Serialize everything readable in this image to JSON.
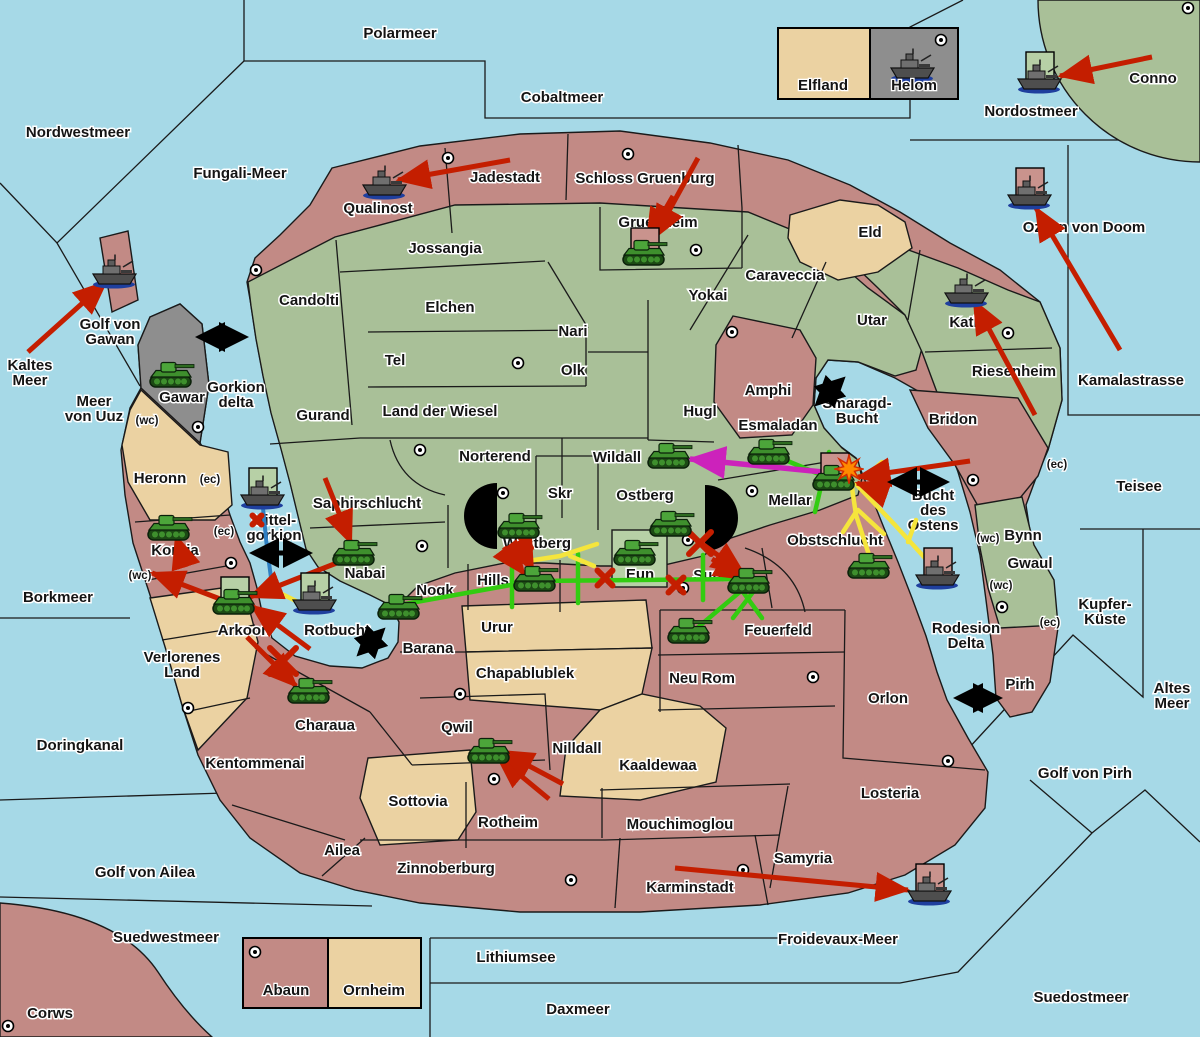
{
  "colors": {
    "sea": "#A6D9E7",
    "land_green": "#A9C098",
    "land_pink": "#C28A85",
    "land_tan": "#EBD2A2",
    "land_gray": "#8E8E8E",
    "box_green": "#B7D0A6",
    "box_pink": "#C9938D",
    "arrow_red": "#C41E00",
    "line_green": "#33CC11",
    "line_yellow": "#F5E53C",
    "line_magenta": "#CC22BB",
    "line_blue": "#2E7FC2",
    "strait_black": "#000000",
    "explosion_orange": "#FF8A00"
  },
  "sea_labels": [
    {
      "text": "Polarmeer",
      "x": 400,
      "y": 38
    },
    {
      "text": "Cobaltmeer",
      "x": 562,
      "y": 102
    },
    {
      "text": "Nordwestmeer",
      "x": 78,
      "y": 137
    },
    {
      "text": "Fungali-Meer",
      "x": 240,
      "y": 178
    },
    {
      "text": "Nordostmeer",
      "x": 1031,
      "y": 116
    },
    {
      "text": "Ozean von Doom",
      "x": 1084,
      "y": 232
    },
    {
      "text": "Kamalastrasse",
      "x": 1131,
      "y": 385
    },
    {
      "text": "Teisee",
      "x": 1139,
      "y": 491
    },
    {
      "text": "Kaltes\nMeer",
      "x": 30,
      "y": 370
    },
    {
      "text": "Meer\nvon Uuz",
      "x": 94,
      "y": 406
    },
    {
      "text": "Golf von\nGawan",
      "x": 110,
      "y": 329
    },
    {
      "text": "Gorkion\ndelta",
      "x": 236,
      "y": 392
    },
    {
      "text": "Mittel-\ngorkion",
      "x": 274,
      "y": 525
    },
    {
      "text": "Borkmeer",
      "x": 58,
      "y": 602
    },
    {
      "text": "Rotbucht",
      "x": 337,
      "y": 635
    },
    {
      "text": "Doringkanal",
      "x": 80,
      "y": 750
    },
    {
      "text": "Golf von Ailea",
      "x": 145,
      "y": 877
    },
    {
      "text": "Suedwestmeer",
      "x": 166,
      "y": 942
    },
    {
      "text": "Lithiumsee",
      "x": 516,
      "y": 962
    },
    {
      "text": "Daxmeer",
      "x": 578,
      "y": 1014
    },
    {
      "text": "Froidevaux-Meer",
      "x": 838,
      "y": 944
    },
    {
      "text": "Suedostmeer",
      "x": 1081,
      "y": 1002
    },
    {
      "text": "Golf von Pirh",
      "x": 1085,
      "y": 778
    },
    {
      "text": "Altes\nMeer",
      "x": 1172,
      "y": 693
    },
    {
      "text": "Kupfer-\nKüste",
      "x": 1105,
      "y": 609
    },
    {
      "text": "Smaragd-\nBucht",
      "x": 857,
      "y": 408
    },
    {
      "text": "Bucht\ndes\nOstens",
      "x": 933,
      "y": 500
    },
    {
      "text": "Rodesion\nDelta",
      "x": 966,
      "y": 633
    }
  ],
  "territory_labels": [
    {
      "text": "Qualinost",
      "x": 378,
      "y": 213
    },
    {
      "text": "Jadestadt",
      "x": 505,
      "y": 182
    },
    {
      "text": "Schloss Gruenburg",
      "x": 645,
      "y": 183
    },
    {
      "text": "Gruenheim",
      "x": 658,
      "y": 227
    },
    {
      "text": "Eld",
      "x": 870,
      "y": 237
    },
    {
      "text": "Conno",
      "x": 1153,
      "y": 83
    },
    {
      "text": "Jossangia",
      "x": 445,
      "y": 253
    },
    {
      "text": "Candolti",
      "x": 309,
      "y": 305
    },
    {
      "text": "Elchen",
      "x": 450,
      "y": 312
    },
    {
      "text": "Tel",
      "x": 395,
      "y": 365
    },
    {
      "text": "Nari",
      "x": 573,
      "y": 336
    },
    {
      "text": "Olk",
      "x": 573,
      "y": 375
    },
    {
      "text": "Yokai",
      "x": 708,
      "y": 300
    },
    {
      "text": "Caraveccia",
      "x": 785,
      "y": 280
    },
    {
      "text": "Utar",
      "x": 872,
      "y": 325
    },
    {
      "text": "Kath",
      "x": 966,
      "y": 327
    },
    {
      "text": "Riesenheim",
      "x": 1014,
      "y": 376
    },
    {
      "text": "Bridon",
      "x": 953,
      "y": 424
    },
    {
      "text": "Gurand",
      "x": 323,
      "y": 420
    },
    {
      "text": "Land der Wiesel",
      "x": 440,
      "y": 416
    },
    {
      "text": "Hugl",
      "x": 700,
      "y": 416
    },
    {
      "text": "Amphi",
      "x": 768,
      "y": 395
    },
    {
      "text": "Esmaladan",
      "x": 778,
      "y": 430
    },
    {
      "text": "Norterend",
      "x": 495,
      "y": 461
    },
    {
      "text": "Wildall",
      "x": 617,
      "y": 462
    },
    {
      "text": "Skr",
      "x": 560,
      "y": 498
    },
    {
      "text": "Ostberg",
      "x": 645,
      "y": 500
    },
    {
      "text": "Mellar",
      "x": 790,
      "y": 505
    },
    {
      "text": "Gawar",
      "x": 182,
      "y": 402
    },
    {
      "text": "Heronn",
      "x": 160,
      "y": 483
    },
    {
      "text": "Saphirschlucht",
      "x": 367,
      "y": 508
    },
    {
      "text": "Korbia",
      "x": 175,
      "y": 555
    },
    {
      "text": "Nabai",
      "x": 365,
      "y": 578
    },
    {
      "text": "Westberg",
      "x": 537,
      "y": 548
    },
    {
      "text": "Hills",
      "x": 493,
      "y": 585
    },
    {
      "text": "Eun",
      "x": 640,
      "y": 579
    },
    {
      "text": "Sund",
      "x": 712,
      "y": 580
    },
    {
      "text": "Obstschlucht",
      "x": 835,
      "y": 545
    },
    {
      "text": "Nogk",
      "x": 435,
      "y": 595
    },
    {
      "text": "Urur",
      "x": 497,
      "y": 632
    },
    {
      "text": "Barana",
      "x": 428,
      "y": 653
    },
    {
      "text": "Feuerfeld",
      "x": 778,
      "y": 635
    },
    {
      "text": "Arkoon",
      "x": 244,
      "y": 635
    },
    {
      "text": "Verlorenes\nLand",
      "x": 182,
      "y": 662
    },
    {
      "text": "Chapablublek",
      "x": 525,
      "y": 678
    },
    {
      "text": "Neu Rom",
      "x": 702,
      "y": 683
    },
    {
      "text": "Orlon",
      "x": 888,
      "y": 703
    },
    {
      "text": "Charaua",
      "x": 325,
      "y": 730
    },
    {
      "text": "Qwil",
      "x": 457,
      "y": 732
    },
    {
      "text": "Nilldall",
      "x": 577,
      "y": 753
    },
    {
      "text": "Kentommenai",
      "x": 255,
      "y": 768
    },
    {
      "text": "Kaaldewaa",
      "x": 658,
      "y": 770
    },
    {
      "text": "Sottovia",
      "x": 418,
      "y": 806
    },
    {
      "text": "Rotheim",
      "x": 508,
      "y": 827
    },
    {
      "text": "Mouchimoglou",
      "x": 680,
      "y": 829
    },
    {
      "text": "Ailea",
      "x": 342,
      "y": 855
    },
    {
      "text": "Zinnoberburg",
      "x": 446,
      "y": 873
    },
    {
      "text": "Samyria",
      "x": 803,
      "y": 863
    },
    {
      "text": "Losteria",
      "x": 890,
      "y": 798
    },
    {
      "text": "Karminstadt",
      "x": 690,
      "y": 892
    },
    {
      "text": "Bynn",
      "x": 1023,
      "y": 540
    },
    {
      "text": "Gwaul",
      "x": 1030,
      "y": 568
    },
    {
      "text": "Pirh",
      "x": 1020,
      "y": 689
    },
    {
      "text": "Corws",
      "x": 50,
      "y": 1018
    }
  ],
  "small_labels": [
    {
      "text": "(wc)",
      "x": 147,
      "y": 424
    },
    {
      "text": "(ec)",
      "x": 210,
      "y": 483
    },
    {
      "text": "(ec)",
      "x": 224,
      "y": 535
    },
    {
      "text": "(wc)",
      "x": 140,
      "y": 579
    },
    {
      "text": "(ec)",
      "x": 1057,
      "y": 468
    },
    {
      "text": "(wc)",
      "x": 988,
      "y": 542
    },
    {
      "text": "(wc)",
      "x": 1001,
      "y": 589
    },
    {
      "text": "(ec)",
      "x": 1050,
      "y": 626
    }
  ],
  "capital_dots": [
    [
      448,
      158
    ],
    [
      628,
      154
    ],
    [
      696,
      250
    ],
    [
      256,
      270
    ],
    [
      518,
      363
    ],
    [
      732,
      332
    ],
    [
      420,
      450
    ],
    [
      503,
      493
    ],
    [
      752,
      491
    ],
    [
      688,
      540
    ],
    [
      683,
      588
    ],
    [
      198,
      427
    ],
    [
      231,
      563
    ],
    [
      422,
      546
    ],
    [
      188,
      708
    ],
    [
      460,
      694
    ],
    [
      494,
      779
    ],
    [
      571,
      880
    ],
    [
      743,
      870
    ],
    [
      813,
      677
    ],
    [
      973,
      480
    ],
    [
      1002,
      607
    ],
    [
      948,
      761
    ],
    [
      1008,
      333
    ],
    [
      1188,
      8
    ],
    [
      941,
      40
    ],
    [
      255,
      952
    ],
    [
      8,
      1026
    ]
  ],
  "tanks": [
    {
      "x": 172,
      "y": 375,
      "box": null,
      "loc": "Gawar"
    },
    {
      "x": 645,
      "y": 253,
      "box": "pink",
      "loc": "Gruenheim"
    },
    {
      "x": 670,
      "y": 456,
      "box": null,
      "loc": "Wildall"
    },
    {
      "x": 770,
      "y": 452,
      "box": null,
      "loc": "Esmaladan"
    },
    {
      "x": 835,
      "y": 478,
      "box": "pink",
      "loc": "Mellar"
    },
    {
      "x": 170,
      "y": 528,
      "box": null,
      "loc": "Korbia"
    },
    {
      "x": 355,
      "y": 553,
      "box": null,
      "loc": "Nabai"
    },
    {
      "x": 235,
      "y": 602,
      "box": "green",
      "loc": "Arkoon"
    },
    {
      "x": 310,
      "y": 691,
      "box": null,
      "loc": "Charaua"
    },
    {
      "x": 400,
      "y": 607,
      "box": null,
      "loc": "Nogk"
    },
    {
      "x": 520,
      "y": 526,
      "box": null,
      "loc": "Westberg"
    },
    {
      "x": 536,
      "y": 579,
      "box": null,
      "loc": "Hills"
    },
    {
      "x": 636,
      "y": 553,
      "box": null,
      "loc": "Eun"
    },
    {
      "x": 672,
      "y": 524,
      "box": null,
      "loc": "Ostberg"
    },
    {
      "x": 750,
      "y": 581,
      "box": null,
      "loc": "Sund"
    },
    {
      "x": 690,
      "y": 631,
      "box": null,
      "loc": "Feuerfeld"
    },
    {
      "x": 870,
      "y": 566,
      "box": null,
      "loc": "Obstschlucht"
    },
    {
      "x": 490,
      "y": 751,
      "box": null,
      "loc": "Rotheim"
    }
  ],
  "ships": [
    {
      "x": 385,
      "y": 183,
      "box": null,
      "loc": "Qualinost"
    },
    {
      "x": 115,
      "y": 272,
      "box": null,
      "loc": "Golf von Gawan"
    },
    {
      "x": 263,
      "y": 493,
      "box": "green",
      "loc": "Mittelgorkion"
    },
    {
      "x": 315,
      "y": 598,
      "box": "green",
      "loc": "Rotbucht"
    },
    {
      "x": 1040,
      "y": 77,
      "box": "green",
      "loc": "Nordostmeer"
    },
    {
      "x": 1030,
      "y": 193,
      "box": "pink",
      "loc": "Ozean von Doom"
    },
    {
      "x": 967,
      "y": 291,
      "box": null,
      "loc": "Kath"
    },
    {
      "x": 938,
      "y": 573,
      "box": "pink",
      "loc": "Bucht des Ostens"
    },
    {
      "x": 930,
      "y": 889,
      "box": "pink",
      "loc": "Froidevaux-Meer"
    }
  ],
  "red_arrows": [
    [
      510,
      160,
      398,
      180
    ],
    [
      28,
      352,
      106,
      282
    ],
    [
      698,
      158,
      654,
      238
    ],
    [
      673,
      196,
      647,
      241
    ],
    [
      1152,
      57,
      1060,
      76
    ],
    [
      1120,
      350,
      1036,
      208
    ],
    [
      1035,
      415,
      974,
      301
    ],
    [
      970,
      461,
      858,
      477
    ],
    [
      880,
      491,
      857,
      483
    ],
    [
      325,
      478,
      351,
      543
    ],
    [
      352,
      557,
      250,
      597
    ],
    [
      310,
      649,
      252,
      606
    ],
    [
      247,
      637,
      296,
      686
    ],
    [
      186,
      567,
      176,
      536
    ],
    [
      228,
      602,
      152,
      573
    ],
    [
      518,
      541,
      533,
      571
    ],
    [
      504,
      547,
      524,
      574
    ],
    [
      683,
      530,
      744,
      574
    ],
    [
      712,
      559,
      747,
      579
    ],
    [
      549,
      799,
      497,
      756
    ],
    [
      563,
      784,
      501,
      751
    ],
    [
      675,
      868,
      908,
      890
    ]
  ],
  "magenta_arrows": [
    [
      823,
      472,
      690,
      459
    ]
  ],
  "green_lines": [
    [
      [
        405,
        604
      ],
      [
        533,
        581
      ]
    ],
    [
      [
        535,
        581
      ],
      [
        743,
        579
      ]
    ],
    [
      [
        512,
        559
      ],
      [
        512,
        607
      ]
    ],
    [
      [
        578,
        554
      ],
      [
        578,
        603
      ]
    ],
    [
      [
        703,
        555
      ],
      [
        703,
        600
      ]
    ],
    [
      [
        748,
        585
      ],
      [
        696,
        629
      ]
    ],
    [
      [
        735,
        581
      ],
      [
        762,
        618
      ]
    ],
    [
      [
        760,
        583
      ],
      [
        733,
        618
      ]
    ],
    [
      [
        778,
        457
      ],
      [
        826,
        477
      ]
    ],
    [
      [
        829,
        452
      ],
      [
        815,
        512
      ]
    ]
  ],
  "yellow_lines": [
    [
      [
        528,
        561
      ],
      [
        560,
        556
      ],
      [
        597,
        544
      ]
    ],
    [
      [
        570,
        556
      ],
      [
        594,
        566
      ]
    ],
    [
      [
        851,
        481
      ],
      [
        856,
        515
      ],
      [
        870,
        558
      ]
    ],
    [
      [
        843,
        532
      ],
      [
        856,
        512
      ]
    ],
    [
      [
        884,
        534
      ],
      [
        858,
        510
      ]
    ],
    [
      [
        856,
        484
      ],
      [
        895,
        525
      ],
      [
        934,
        568
      ]
    ],
    [
      [
        908,
        542
      ],
      [
        916,
        520
      ]
    ],
    [
      [
        270,
        588
      ],
      [
        292,
        599
      ],
      [
        309,
        608
      ]
    ],
    [
      [
        865,
        477
      ],
      [
        882,
        462
      ]
    ]
  ],
  "blue_lines": [
    [
      [
        263,
        508
      ],
      [
        267,
        548
      ],
      [
        272,
        585
      ]
    ]
  ],
  "x_marks": [
    [
      283,
      661,
      26
    ],
    [
      524,
      541,
      14
    ],
    [
      605,
      578,
      15
    ],
    [
      676,
      585,
      15
    ],
    [
      700,
      543,
      22
    ],
    [
      257,
      520,
      9
    ]
  ],
  "straits": [
    [
      200,
      337,
      244,
      337
    ],
    [
      254,
      553,
      308,
      553
    ],
    [
      360,
      653,
      382,
      631
    ],
    [
      818,
      403,
      842,
      380
    ],
    [
      892,
      482,
      945,
      482
    ],
    [
      958,
      698,
      998,
      698
    ]
  ],
  "explosions": [
    [
      849,
      469
    ]
  ],
  "legend_top": {
    "cells": [
      {
        "label": "Elfland"
      },
      {
        "label": "Helom"
      }
    ]
  },
  "legend_bottom": {
    "cells": [
      {
        "label": "Abaun"
      },
      {
        "label": "Ornheim"
      }
    ]
  }
}
